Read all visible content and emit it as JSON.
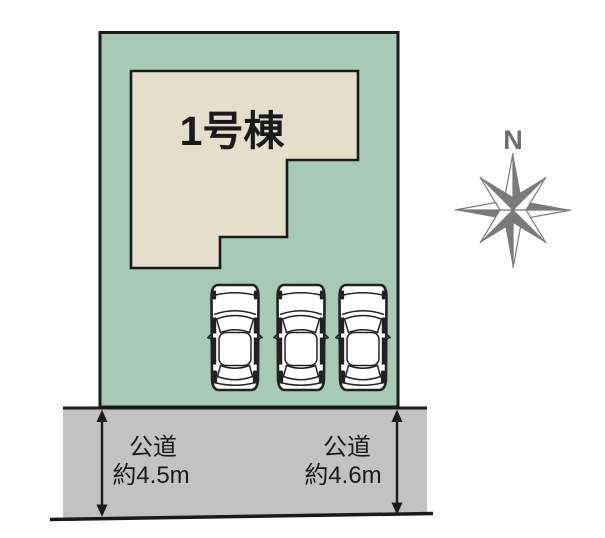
{
  "site_plan": {
    "title_note": "lot layout drawing",
    "building": {
      "label": "1号棟"
    },
    "roads": [
      {
        "name": "公道",
        "width_label": "約4.5m",
        "side": "left"
      },
      {
        "name": "公道",
        "width_label": "約4.6m",
        "side": "right"
      }
    ],
    "compass": {
      "north_label": "N"
    },
    "cars_count": 3,
    "colors": {
      "plot_green": "#a6cab6",
      "building_beige": "#e5decb",
      "road_gray": "#c2c2c2",
      "compass_gray": "#7a7a7a",
      "line_black": "#1a1a1a"
    }
  }
}
